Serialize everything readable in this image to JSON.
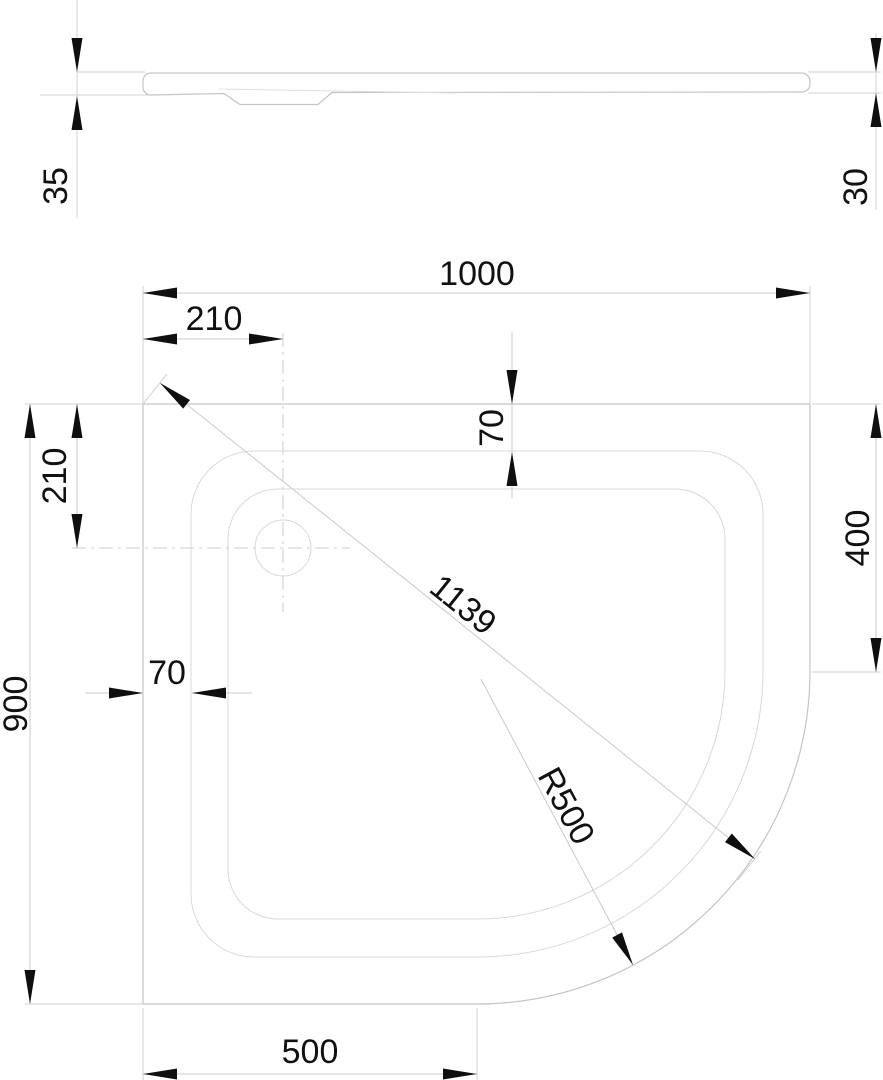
{
  "drawing": {
    "type": "technical-dimension-drawing",
    "subject": "quadrant shower tray",
    "units": "mm",
    "dimensions": {
      "side": {
        "height_left": "35",
        "height_right": "30"
      },
      "plan": {
        "width": "1000",
        "drain_offset_x": "210",
        "rim_inset_top": "70",
        "drain_offset_y": "210",
        "depth": "900",
        "rim_inset_left": "70",
        "edge_right_straight": "400",
        "edge_bottom_straight": "500",
        "diagonal": "1139",
        "corner_radius": "R500"
      }
    }
  }
}
